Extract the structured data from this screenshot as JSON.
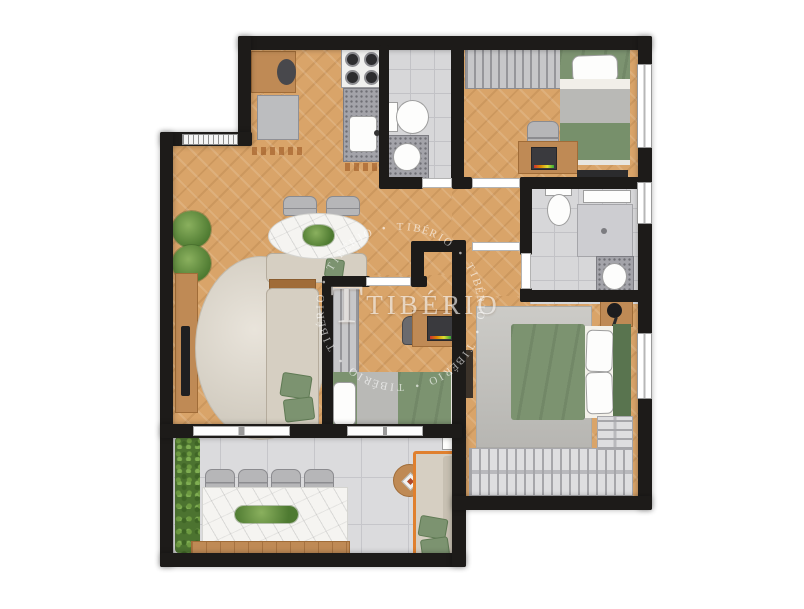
{
  "watermark": {
    "logo_mark": "T",
    "logo_text": "TIBÉRIO",
    "ring_text": "TIBÉRIO • TIBÉRIO • TIBÉRIO • TIBÉRIO • TIBÉRIO • TIBÉRIO • "
  },
  "palette": {
    "wall": "#1d1b19",
    "wood": "#d9a469",
    "woodfurn": "#bf8a55",
    "woodfurndark": "#a06c38",
    "tile": "#d7d7d9",
    "granite": "#a3a3a9",
    "marble": "#f5f4f1",
    "green": "#7c9370",
    "greendark": "#59744f",
    "hedge": "#4c7330",
    "beige": "#d6cfc2",
    "grayfurn": "#b6b6b8",
    "rug": "#d9d3c8",
    "orange": "#e0802e",
    "watermark": "rgba(255,255,255,0.62)"
  }
}
